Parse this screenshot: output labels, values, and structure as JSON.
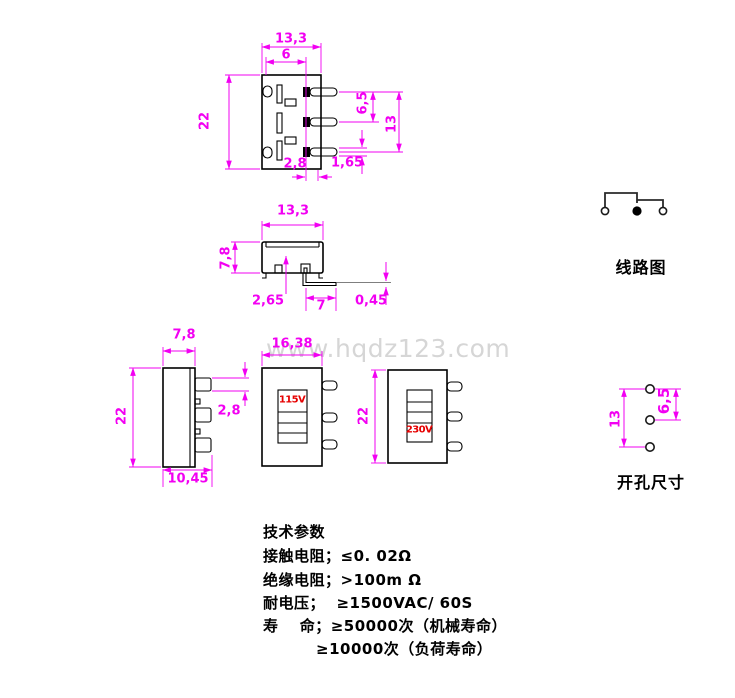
{
  "dims": {
    "front": {
      "width": "13,3",
      "slot": "6",
      "height": "22",
      "pin_pitch": "6,5",
      "pin_span": "13",
      "pin_offset": "2,8",
      "pin_thick": "1,65"
    },
    "side": {
      "width": "13,3",
      "height": "7,8",
      "offset": "2,65",
      "pin_len": "7",
      "pin_thick": "0,45"
    },
    "left": {
      "width": "7,8",
      "height": "22",
      "pin_thick": "2,8",
      "depth": "10,45"
    },
    "front115": {
      "width": "16,38"
    },
    "front230": {
      "height": "22"
    },
    "holes": {
      "span": "13",
      "pitch": "6,5"
    }
  },
  "switch_labels": {
    "pos115": "115V",
    "pos230": "230V"
  },
  "captions": {
    "circuit": "线路图",
    "holes": "开孔尺寸"
  },
  "specs": {
    "title": "技术参数",
    "lines": [
      "接触电阻；≤0. 02Ω",
      "绝缘电阻；>100m Ω",
      "耐电压；  ≥1500VAC/ 60S",
      "寿　 命；≥50000次（机械寿命）",
      "≥10000次（负荷寿命）"
    ]
  },
  "watermark": "www.hqdz123.com",
  "colors": {
    "dimension": "#FF00FF",
    "voltage_label": "#E60000",
    "linework": "#000000",
    "watermark": "#D6D6D6"
  }
}
